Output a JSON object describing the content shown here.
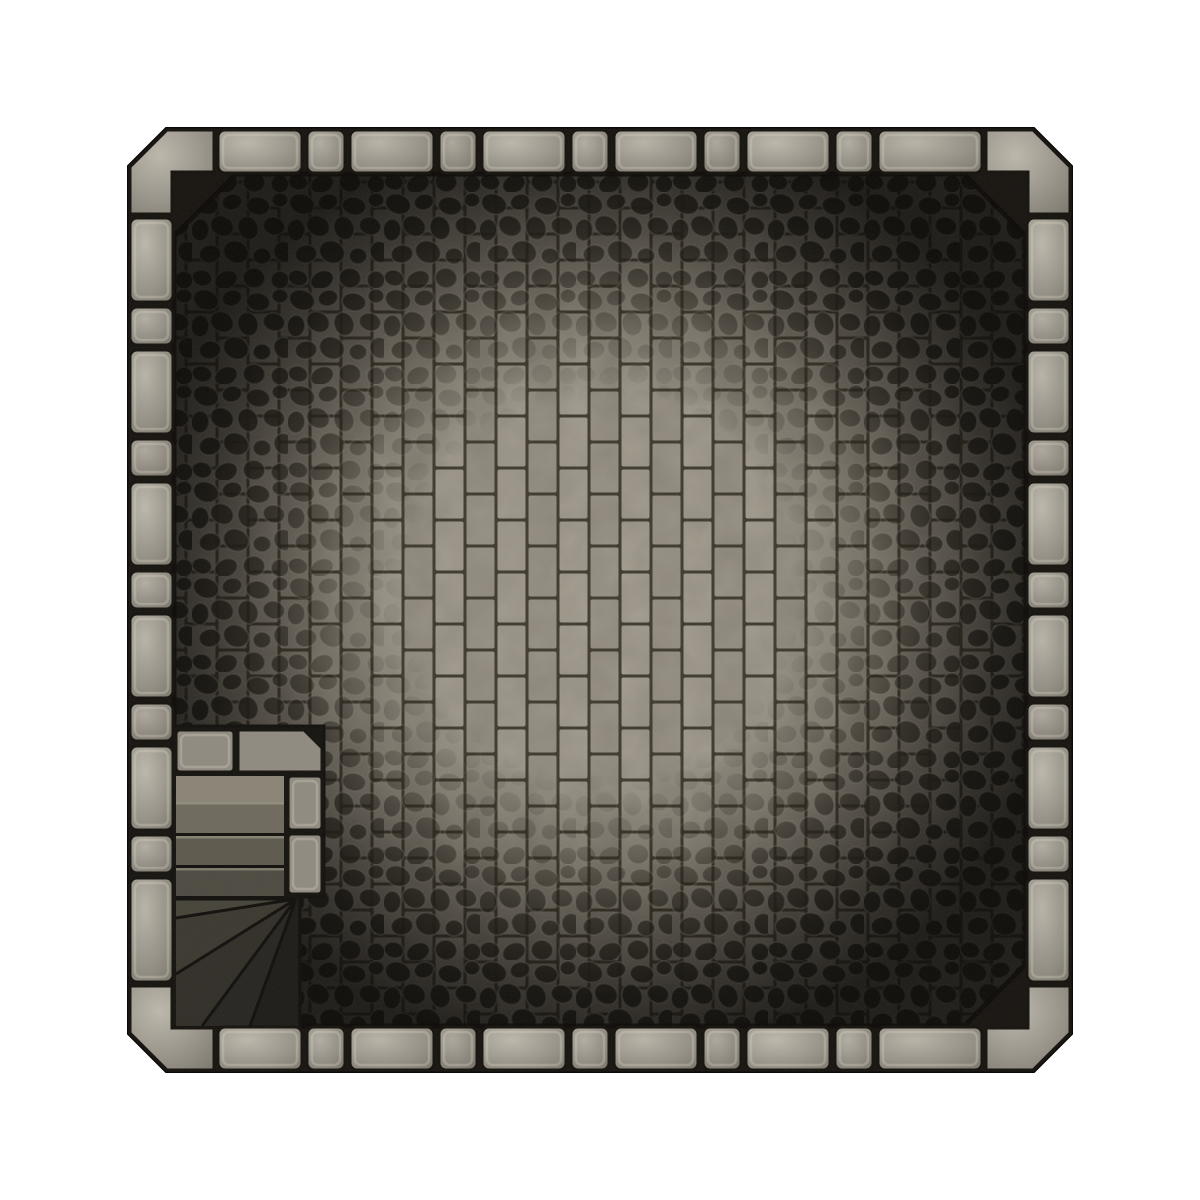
{
  "page": {
    "background": "#ffffff"
  },
  "map": {
    "outer_wall_polygon": [
      [
        128,
        166
      ],
      [
        166,
        128
      ],
      [
        1034,
        128
      ],
      [
        1072,
        166
      ],
      [
        1072,
        1034
      ],
      [
        1034,
        1072
      ],
      [
        166,
        1072
      ],
      [
        128,
        1034
      ]
    ],
    "floor_polygon": [
      [
        174,
        236
      ],
      [
        236,
        174
      ],
      [
        964,
        174
      ],
      [
        1026,
        236
      ],
      [
        1026,
        964
      ],
      [
        964,
        1026
      ],
      [
        236,
        1026
      ],
      [
        174,
        964
      ]
    ],
    "light_center": {
      "cx": 600,
      "cy": 588,
      "r": 470
    }
  },
  "colors": {
    "wall_mortar": "#16130f",
    "wall_outline": "#0c0a08",
    "stone_highlight": "#bdb8ac",
    "stone_mid": "#9a958b",
    "stone_shadow": "#7b766c",
    "block_stroke": "#14110d",
    "block_inner_highlight": "rgba(226,221,206,0.28)",
    "block_shade_tint": "18,15,10",
    "brick_a": "#a7a194",
    "brick_b": "#9c968a",
    "brick_mortar": "#3e392c",
    "cobble_stone": "#221f18",
    "cobble_outline": "rgba(202,197,182,0.5)",
    "floor_outline": "rgba(10,8,5,0.85)",
    "stair_base": "#14120e",
    "stair_stone": "#8f8a80",
    "stair_landing": "#8a8476",
    "stair_treads": [
      "#6e695c",
      "#5c584c",
      "#4c4940"
    ],
    "stair_wedges": [
      "#454238",
      "#3a372f",
      "#2f2d26",
      "#262420",
      "#1c1a16"
    ],
    "stair_line": "#100e0b",
    "tread_highlight": "rgba(210,205,190,0.35)",
    "grain_rgb": [
      0.52,
      0.5,
      0.45
    ]
  },
  "walls": {
    "thickness": 43,
    "bands": {
      "near": 130,
      "far": 1027
    },
    "edge_run": {
      "start": 218,
      "end": 982
    },
    "block_lengths": [
      84,
      38
    ],
    "gap": 5,
    "shade_cycle": [
      0,
      0.06,
      0.02,
      0.09
    ],
    "corner_polygons": {
      "top_left": [
        [
          130,
          214
        ],
        [
          130,
          167
        ],
        [
          167,
          130
        ],
        [
          214,
          130
        ],
        [
          214,
          172
        ],
        [
          172,
          172
        ],
        [
          172,
          214
        ]
      ],
      "top_right": [
        [
          986,
          130
        ],
        [
          1033,
          130
        ],
        [
          1070,
          167
        ],
        [
          1070,
          214
        ],
        [
          1028,
          214
        ],
        [
          1028,
          172
        ],
        [
          986,
          172
        ]
      ],
      "bottom_right": [
        [
          1070,
          986
        ],
        [
          1070,
          1033
        ],
        [
          1033,
          1070
        ],
        [
          986,
          1070
        ],
        [
          986,
          1028
        ],
        [
          1028,
          1028
        ],
        [
          1028,
          986
        ]
      ],
      "bottom_left": [
        [
          130,
          986
        ],
        [
          172,
          986
        ],
        [
          172,
          1028
        ],
        [
          214,
          1028
        ],
        [
          214,
          1070
        ],
        [
          167,
          1070
        ],
        [
          130,
          1033
        ]
      ]
    }
  },
  "floor": {
    "brick": {
      "tile_w": 62,
      "tile_h": 52,
      "brick_w": 28,
      "brick_h": 49,
      "inset": 1.5,
      "radius": 2
    },
    "vignette_stops": [
      [
        0,
        "rgba(30,26,20,0)"
      ],
      [
        0.42,
        "rgba(30,26,20,0.04)"
      ],
      [
        0.58,
        "rgba(28,24,18,0.28)"
      ],
      [
        0.72,
        "rgba(22,19,14,0.52)"
      ],
      [
        0.86,
        "rgba(14,12,9,0.72)"
      ],
      [
        1,
        "rgba(9,7,5,0.86)"
      ]
    ],
    "cobble_mask_stops": [
      [
        0,
        "#000000"
      ],
      [
        0.4,
        "#000000"
      ],
      [
        0.56,
        "#404040"
      ],
      [
        0.72,
        "#b0b0b0"
      ],
      [
        0.88,
        "#ffffff"
      ]
    ],
    "cobble_tile": 96,
    "cobbles": [
      [
        14,
        12,
        13,
        10,
        20
      ],
      [
        40,
        10,
        10,
        8,
        -15
      ],
      [
        66,
        14,
        12,
        9,
        10
      ],
      [
        88,
        8,
        8,
        7,
        0
      ],
      [
        8,
        38,
        9,
        11,
        5
      ],
      [
        30,
        34,
        12,
        10,
        30
      ],
      [
        56,
        36,
        10,
        12,
        -20
      ],
      [
        82,
        34,
        11,
        9,
        15
      ],
      [
        18,
        62,
        11,
        9,
        -10
      ],
      [
        44,
        60,
        13,
        11,
        25
      ],
      [
        70,
        64,
        9,
        8,
        0
      ],
      [
        92,
        60,
        10,
        11,
        -30
      ],
      [
        10,
        86,
        10,
        8,
        15
      ],
      [
        34,
        88,
        12,
        9,
        -25
      ],
      [
        62,
        86,
        11,
        10,
        10
      ],
      [
        88,
        88,
        9,
        9,
        0
      ]
    ]
  },
  "stairs": {
    "region_polygon": [
      [
        172,
        726
      ],
      [
        324,
        726
      ],
      [
        324,
        897
      ],
      [
        300,
        897
      ],
      [
        300,
        1027
      ],
      [
        172,
        1027
      ]
    ],
    "blocks": {
      "top_a": [
        176,
        730,
        58,
        42
      ],
      "top_b": [
        [
          238,
          730
        ],
        [
          304,
          730
        ],
        [
          322,
          748
        ],
        [
          322,
          772
        ],
        [
          238,
          772
        ]
      ],
      "pillar_1": [
        288,
        776,
        34,
        54
      ],
      "pillar_2": [
        288,
        834,
        34,
        60
      ]
    },
    "landing": [
      176,
      776,
      108,
      26
    ],
    "treads": [
      [
        176,
        802,
        108,
        34
      ],
      [
        176,
        836,
        108,
        32
      ],
      [
        176,
        868,
        108,
        31
      ]
    ],
    "fan_pivot": [
      296,
      899
    ],
    "fan_wedges": [
      [
        [
          296,
          899
        ],
        [
          176,
          899
        ],
        [
          176,
          918
        ]
      ],
      [
        [
          296,
          899
        ],
        [
          176,
          918
        ],
        [
          176,
          974
        ]
      ],
      [
        [
          296,
          899
        ],
        [
          176,
          974
        ],
        [
          176,
          1026
        ],
        [
          202,
          1026
        ]
      ],
      [
        [
          296,
          899
        ],
        [
          202,
          1026
        ],
        [
          250,
          1026
        ]
      ],
      [
        [
          296,
          899
        ],
        [
          250,
          1026
        ],
        [
          298,
          1026
        ],
        [
          298,
          899
        ]
      ]
    ],
    "fan_rays": [
      [
        176,
        918
      ],
      [
        176,
        974
      ],
      [
        202,
        1026
      ],
      [
        250,
        1026
      ]
    ]
  }
}
